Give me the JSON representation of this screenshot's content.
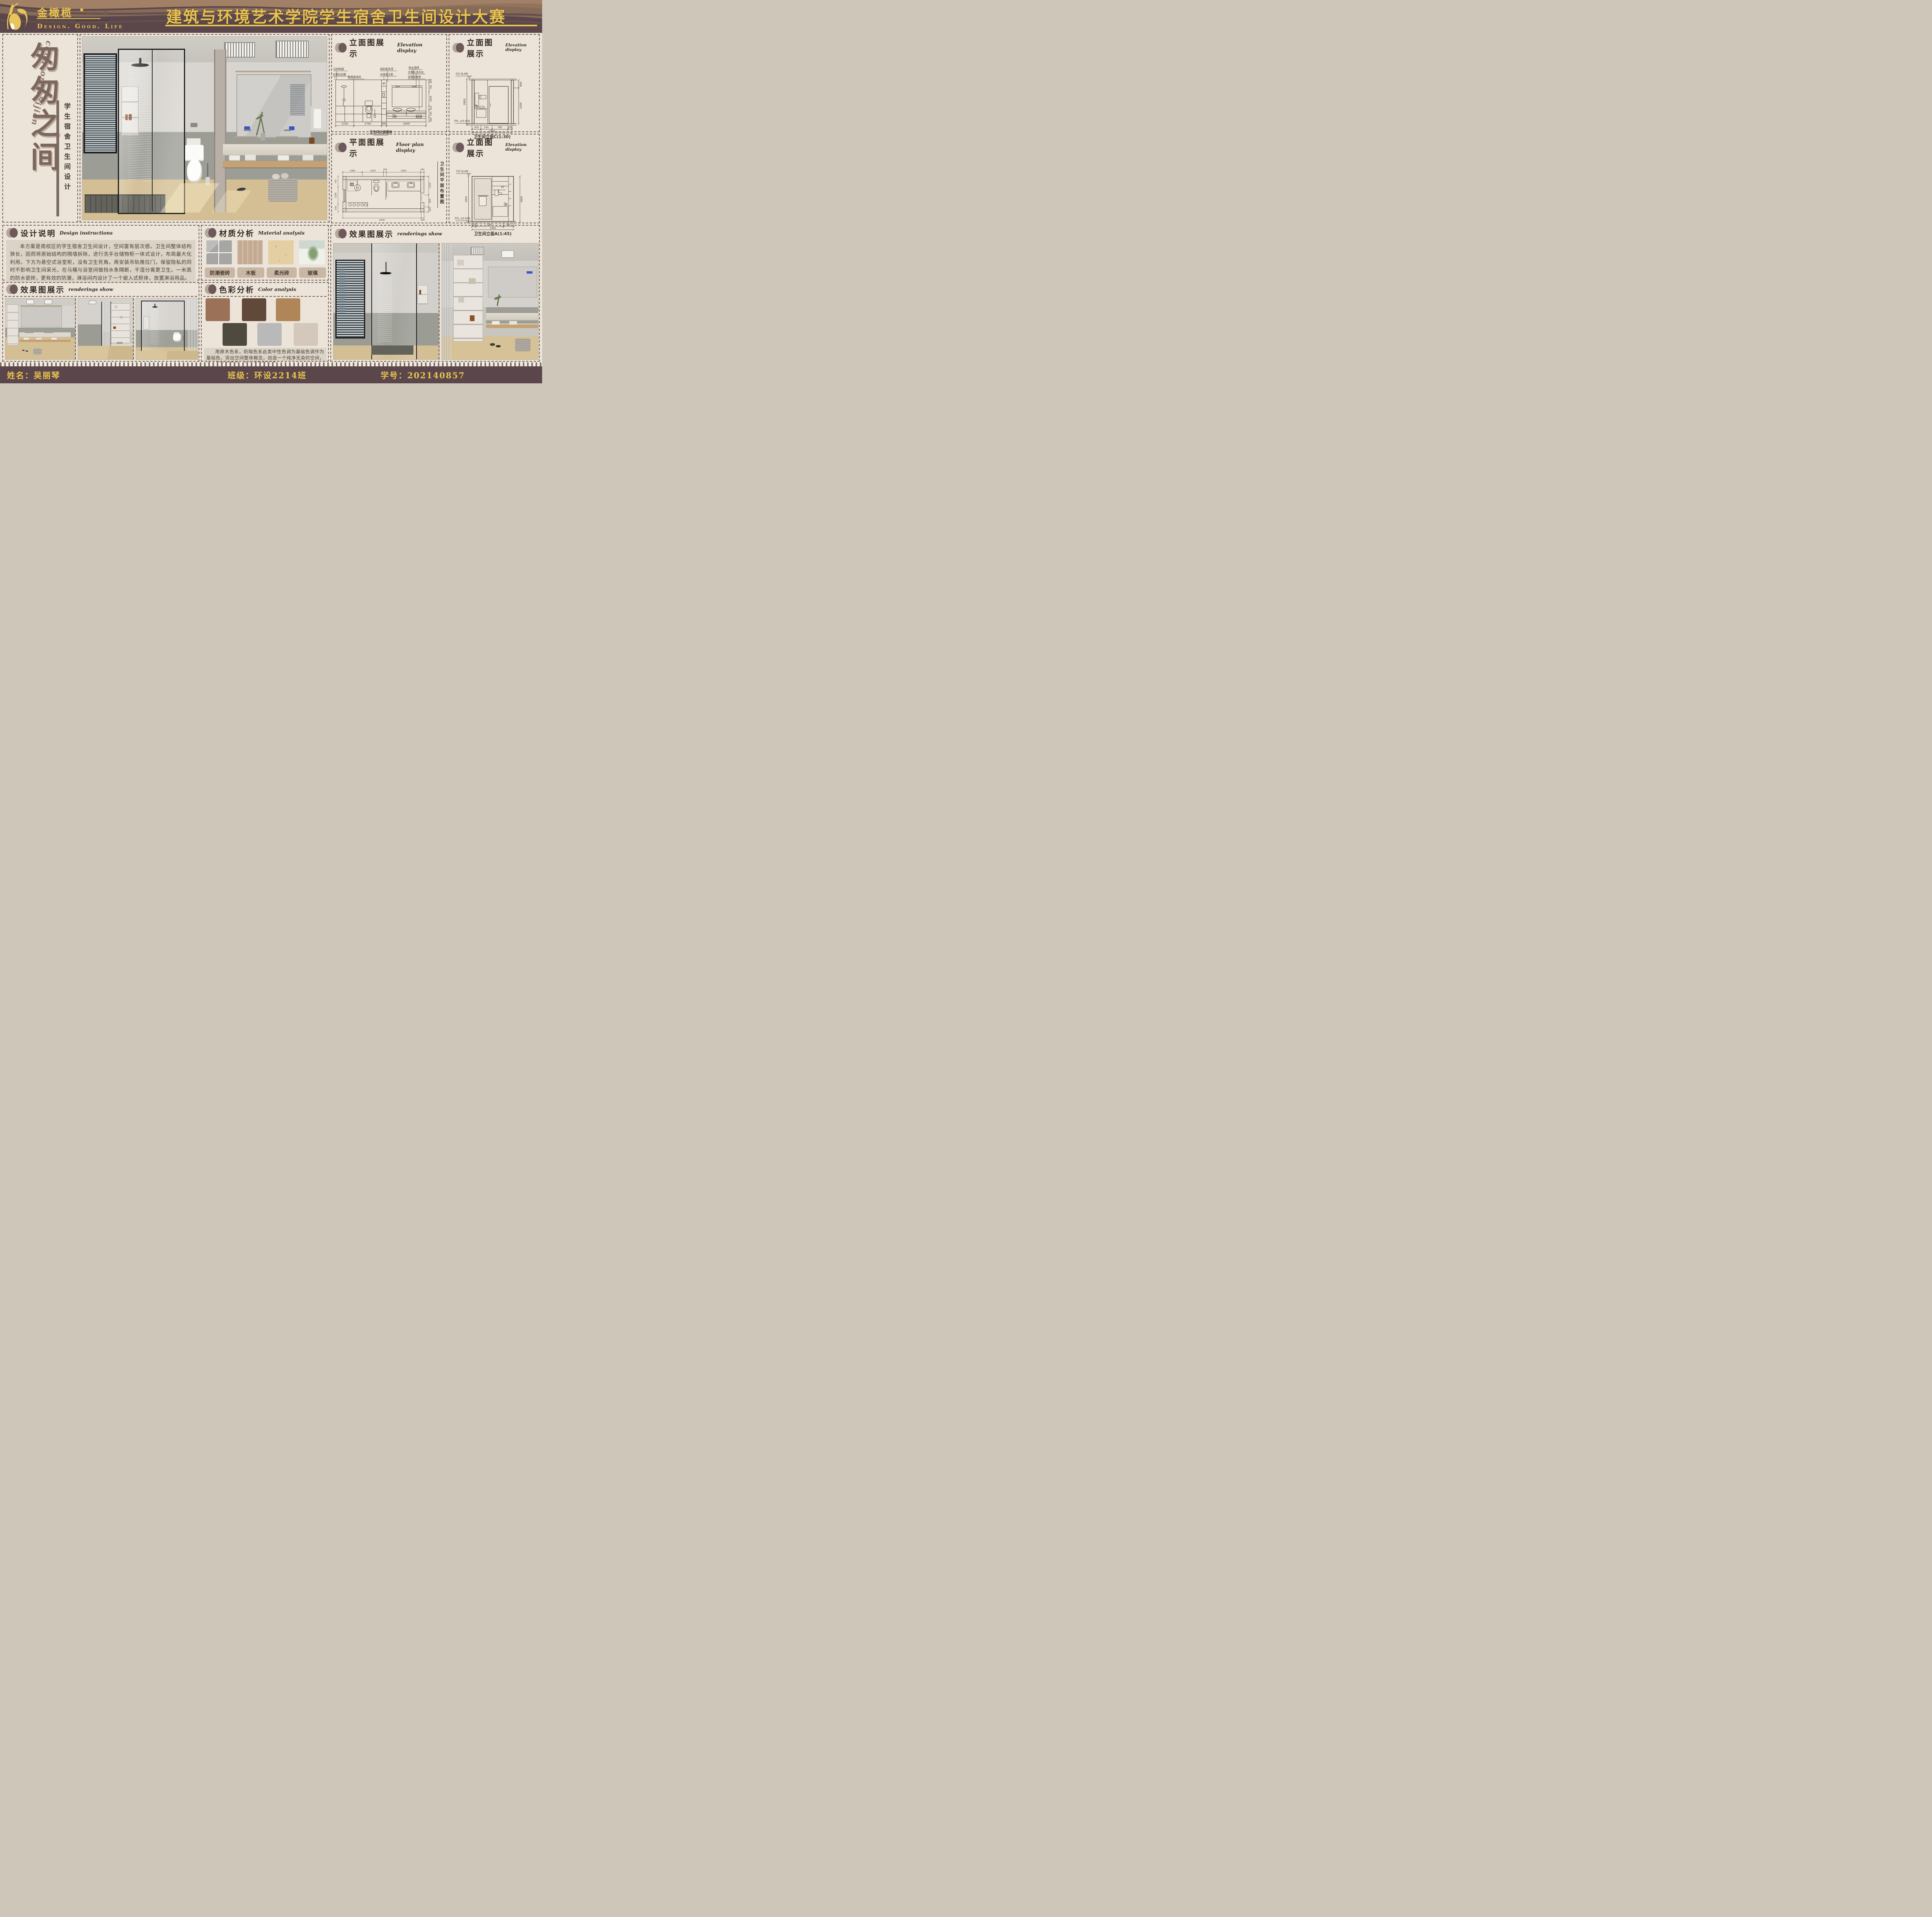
{
  "header": {
    "brand": "金橄榄",
    "brand_sub": "设计大赛",
    "brand_sub_en": "DESIGN COMPETITION",
    "tagline": "Design.  Good.  Life",
    "title": "建筑与环境艺术学院学生宿舍卫生间设计大赛"
  },
  "left_panel": {
    "pinyin": "congcongzhijian",
    "main_title": "匆匆之间",
    "subtitle": "学生宿舍卫生间设计"
  },
  "panels": {
    "elevation_b": {
      "heading": "立面图展示",
      "heading_en": "Elevation display",
      "caption": "卫生间立面图B",
      "labels": [
        "石材饰面",
        "大理石拉槽",
        "玻璃淋浴间",
        "铝扣板吊顶",
        "木饰面立柜",
        "防水瓷砖",
        "大理石洗手台",
        "定制浴室柜"
      ],
      "dims_right": [
        "200",
        "700",
        "1030",
        "310",
        "535",
        "360"
      ],
      "dims_bottom": [
        "1100",
        "1700",
        "300",
        "2400"
      ]
    },
    "elevation_c": {
      "heading": "立面图展示",
      "heading_en": "Elevation display",
      "caption": "卫生间立面C(1:30)",
      "level_top": "CH SLAN",
      "level_bottom": "FFL ±0.000",
      "dim_left": "2800",
      "dims_right": [
        "600",
        "2200"
      ],
      "dims_bottom": [
        "429",
        "545",
        "780",
        "191"
      ],
      "dim_total": "1946"
    },
    "floor_plan": {
      "heading": "平面图展示",
      "heading_en": "Floor plan display",
      "caption_vertical": "卫生间平面布置图",
      "dims_top": [
        "1360",
        "1500",
        "200",
        "2400",
        "240"
      ],
      "dims_right": [
        "1320",
        "850",
        "350"
      ],
      "dims_bottom": [
        "5500",
        "240"
      ],
      "dims_left": [
        "735",
        "1200",
        "535"
      ]
    },
    "elevation_a": {
      "heading": "立面图展示",
      "heading_en": "Elevation display",
      "caption": "卫生间立面A(1:45)",
      "level_top": "CH SLAN",
      "level_bottom": "FFL ±0.000",
      "dim_left": "2800",
      "dim_right": "2800",
      "dims_bottom": [
        "173",
        "1291",
        "482"
      ],
      "dim_total": "1946"
    },
    "design_instructions": {
      "heading": "设计说明",
      "heading_en": "Design instructions",
      "body": "本方案是南校区的学生宿舍卫生间设计，空间富有层次感。卫生间整体结构狭长，因而将原始结构的隔墙拆除，进行洗手台储物柜一体式设计，布局最大化利用。下方为悬空式浴室柜，没有卫生死角。再安装吊轨推拉门，保留隐私的同时不影响卫生间采光，在马桶与浴室间做挡水条隔断，干湿分离更卫生。一米高的防水瓷砖，更有效的防潮，淋浴间内设计了一个嵌入式柜体，放置淋浴用品。"
    },
    "material_analysis": {
      "heading": "材质分析",
      "heading_en": "Material analysis",
      "materials": [
        {
          "name": "防潮瓷砖",
          "color": "#a7a6a4"
        },
        {
          "name": "木板",
          "color": "#c6ac94"
        },
        {
          "name": "柔光砖",
          "color": "#e4cfa5"
        },
        {
          "name": "玻璃",
          "color": "#e7ece6"
        }
      ]
    },
    "color_analysis": {
      "heading": "色彩分析",
      "heading_en": "Color analysis",
      "swatches": [
        "#9b7257",
        "#60493a",
        "#b08557",
        "#4f4a40",
        "#b9b9b9",
        "#d3c8bb"
      ],
      "body": "用原木色系，奶咖色系此类中性色调为基础色调作为基础色，突出空间整体概念，创造一个纯净无染的空间，给人足够包裹感，安全感和舒适感。"
    },
    "renderings_left": {
      "heading": "效果图展示",
      "heading_en": "renderings show"
    },
    "renderings_right": {
      "heading": "效果图展示",
      "heading_en": "renderings show"
    }
  },
  "footer": {
    "name": "姓名：吴丽琴",
    "class": "班级：环设2214班",
    "student_id": "学号：202140857"
  },
  "colors": {
    "plum": "#5b474b",
    "cream": "#ece4d9",
    "gold": "#e9c44f",
    "dash": "#6f5d58",
    "calligraphy": "#7b675d"
  }
}
